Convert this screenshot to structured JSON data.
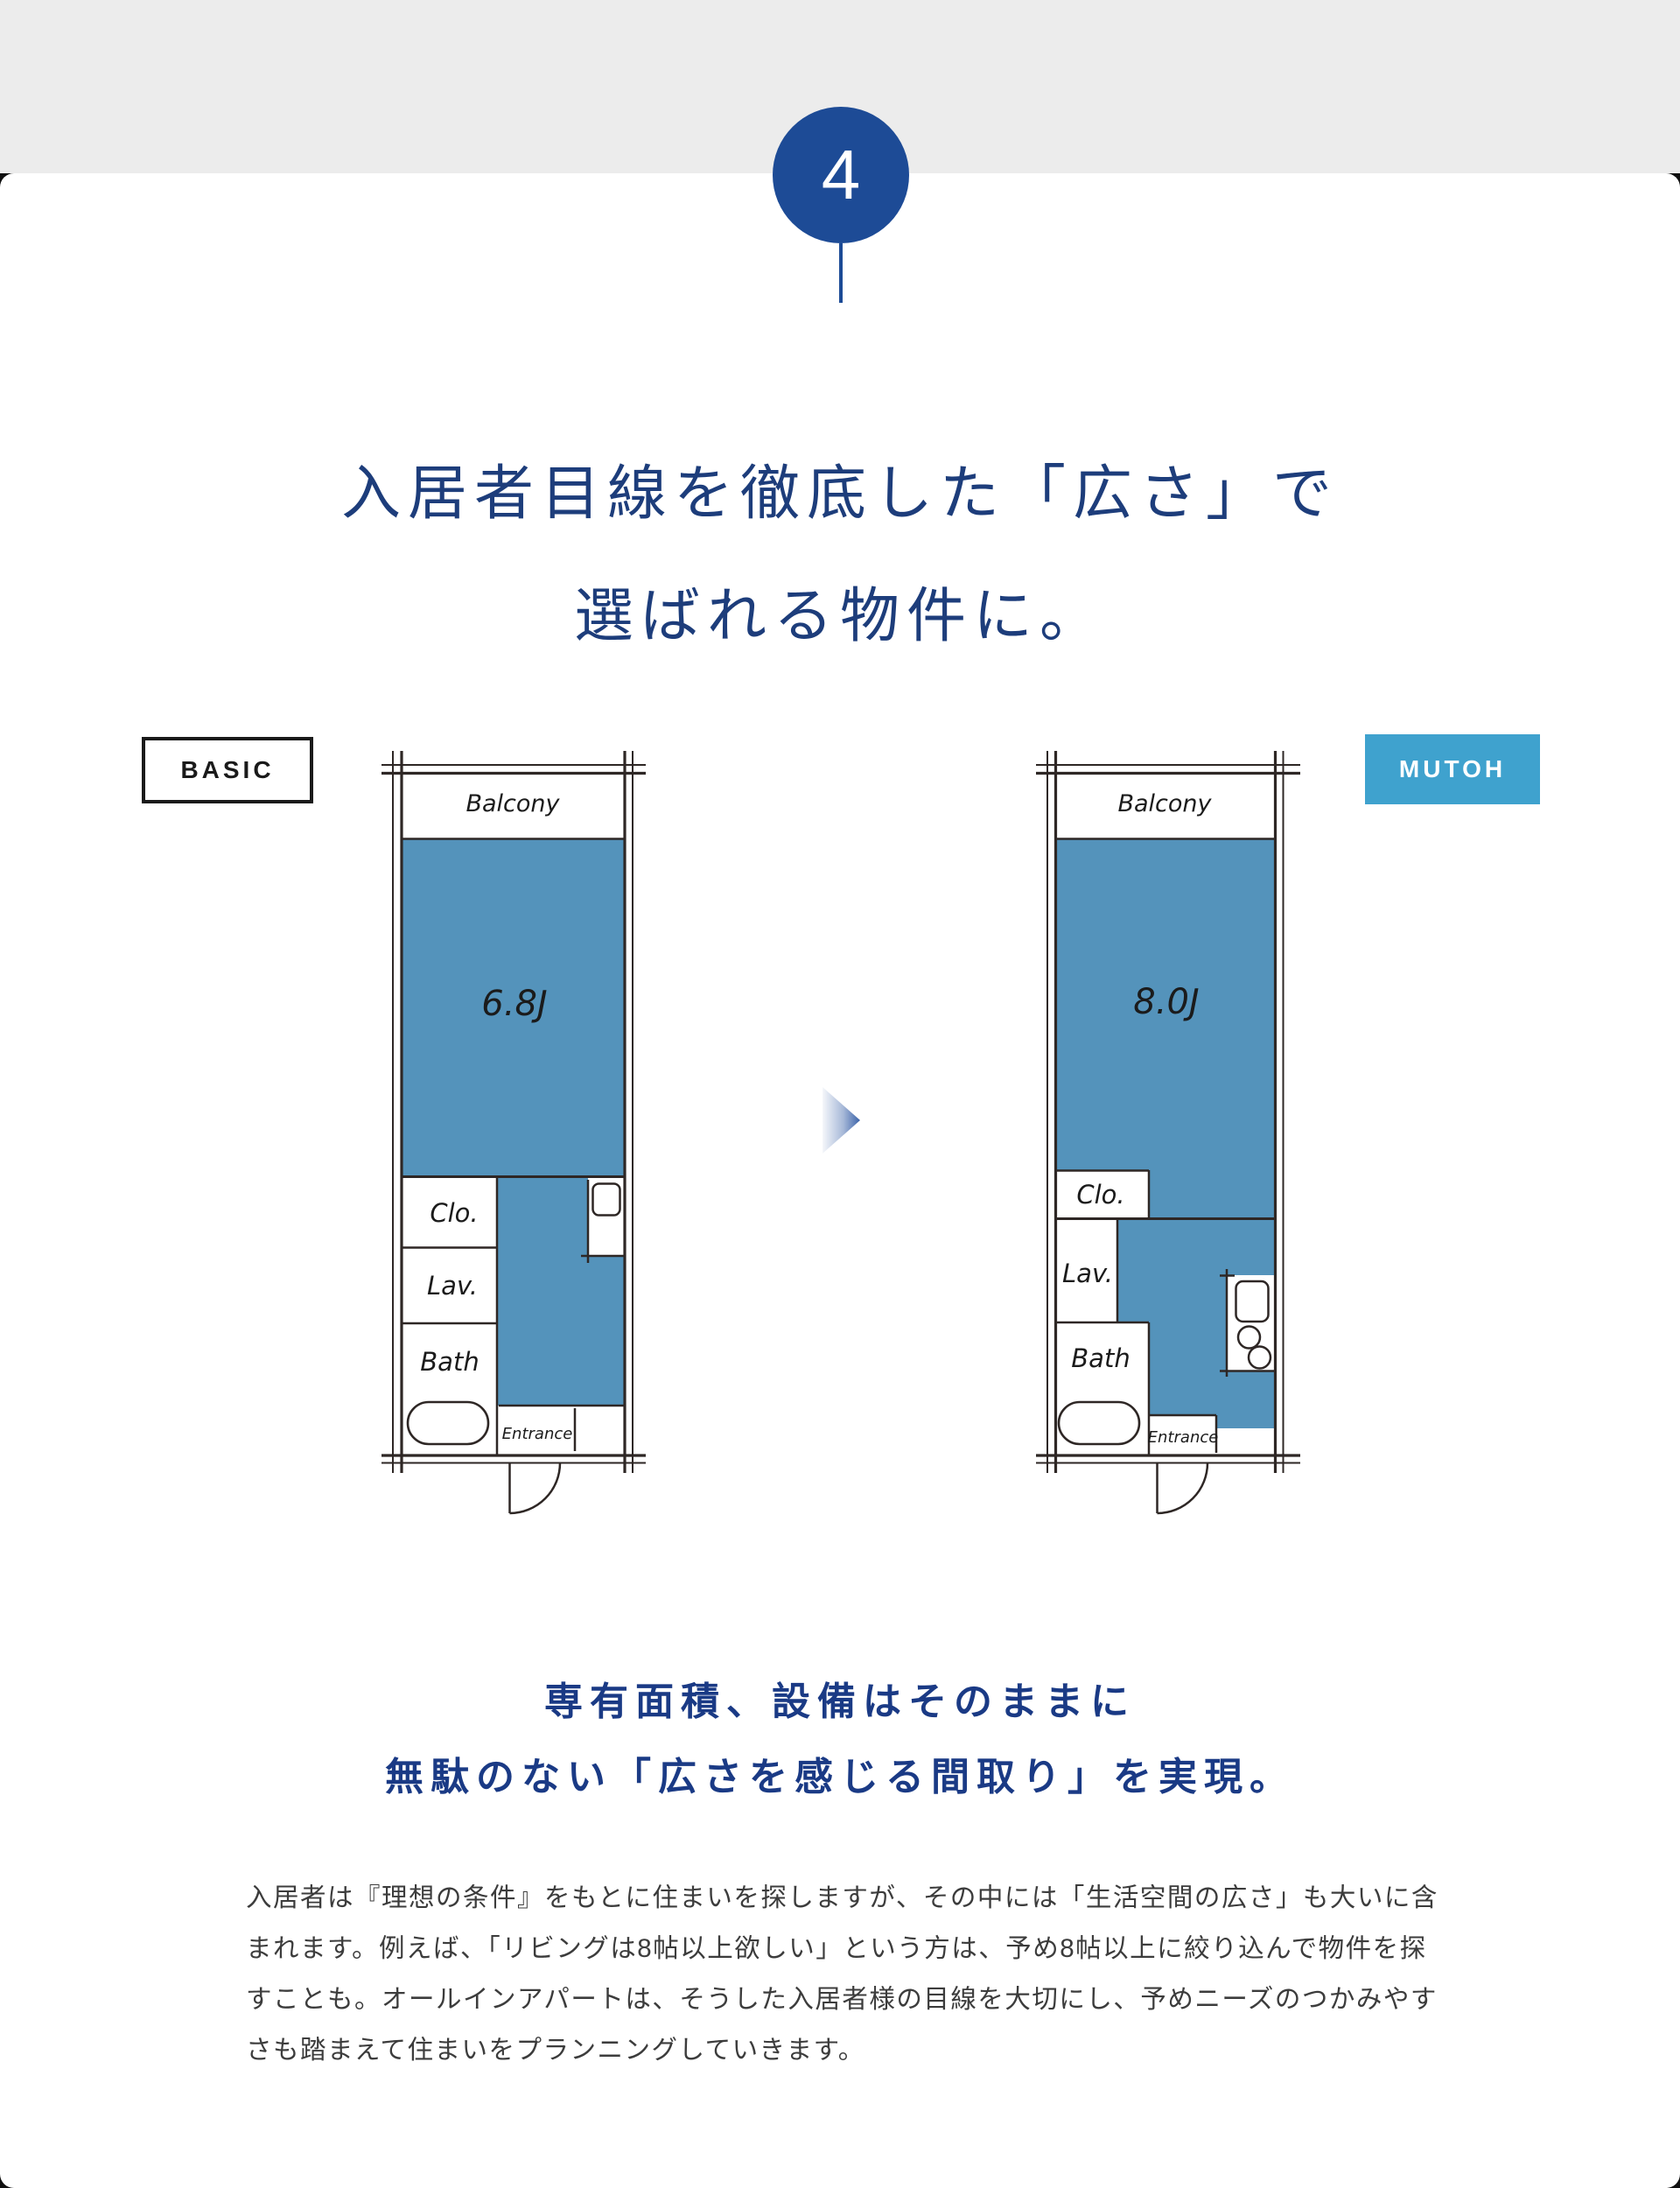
{
  "page": {
    "step_number": "4",
    "title_line1": "入居者目線を徹底した「広さ」で",
    "title_line2": "選ばれる物件に。"
  },
  "comparison": {
    "basic_label": "BASIC",
    "mutoh_label": "MUTOH",
    "basic_plan": {
      "balcony": "Balcony",
      "room_size": "6.8J",
      "closet": "Clo.",
      "lavatory": "Lav.",
      "bath": "Bath",
      "entrance": "Entrance"
    },
    "mutoh_plan": {
      "balcony": "Balcony",
      "room_size": "8.0J",
      "closet": "Clo.",
      "lavatory": "Lav.",
      "bath": "Bath",
      "entrance": "Entrance"
    }
  },
  "subtitle": {
    "line1": "専有面積、設備はそのままに",
    "line2": "無駄のない「広さを感じる間取り」を実現。"
  },
  "body_text": {
    "paragraph": "入居者は『理想の条件』をもとに住まいを探しますが、その中には「生活空間の広さ」も大いに含まれます。例えば、「リビングは8帖以上欲しい」という方は、予め8帖以上に絞り込んで物件を探すことも。オールインアパートは、そうした入居者様の目線を大切にし、予めニーズのつかみやすさも踏まえて住まいをプランニングしていきます。"
  },
  "colors": {
    "badge_navy": "#1d4b96",
    "title_navy": "#1d3d7b",
    "subtitle_navy": "#1a3a85",
    "mutoh_blue": "#3fa2ce",
    "room_blue": "#5493bb",
    "wall_dark": "#2e2725"
  }
}
